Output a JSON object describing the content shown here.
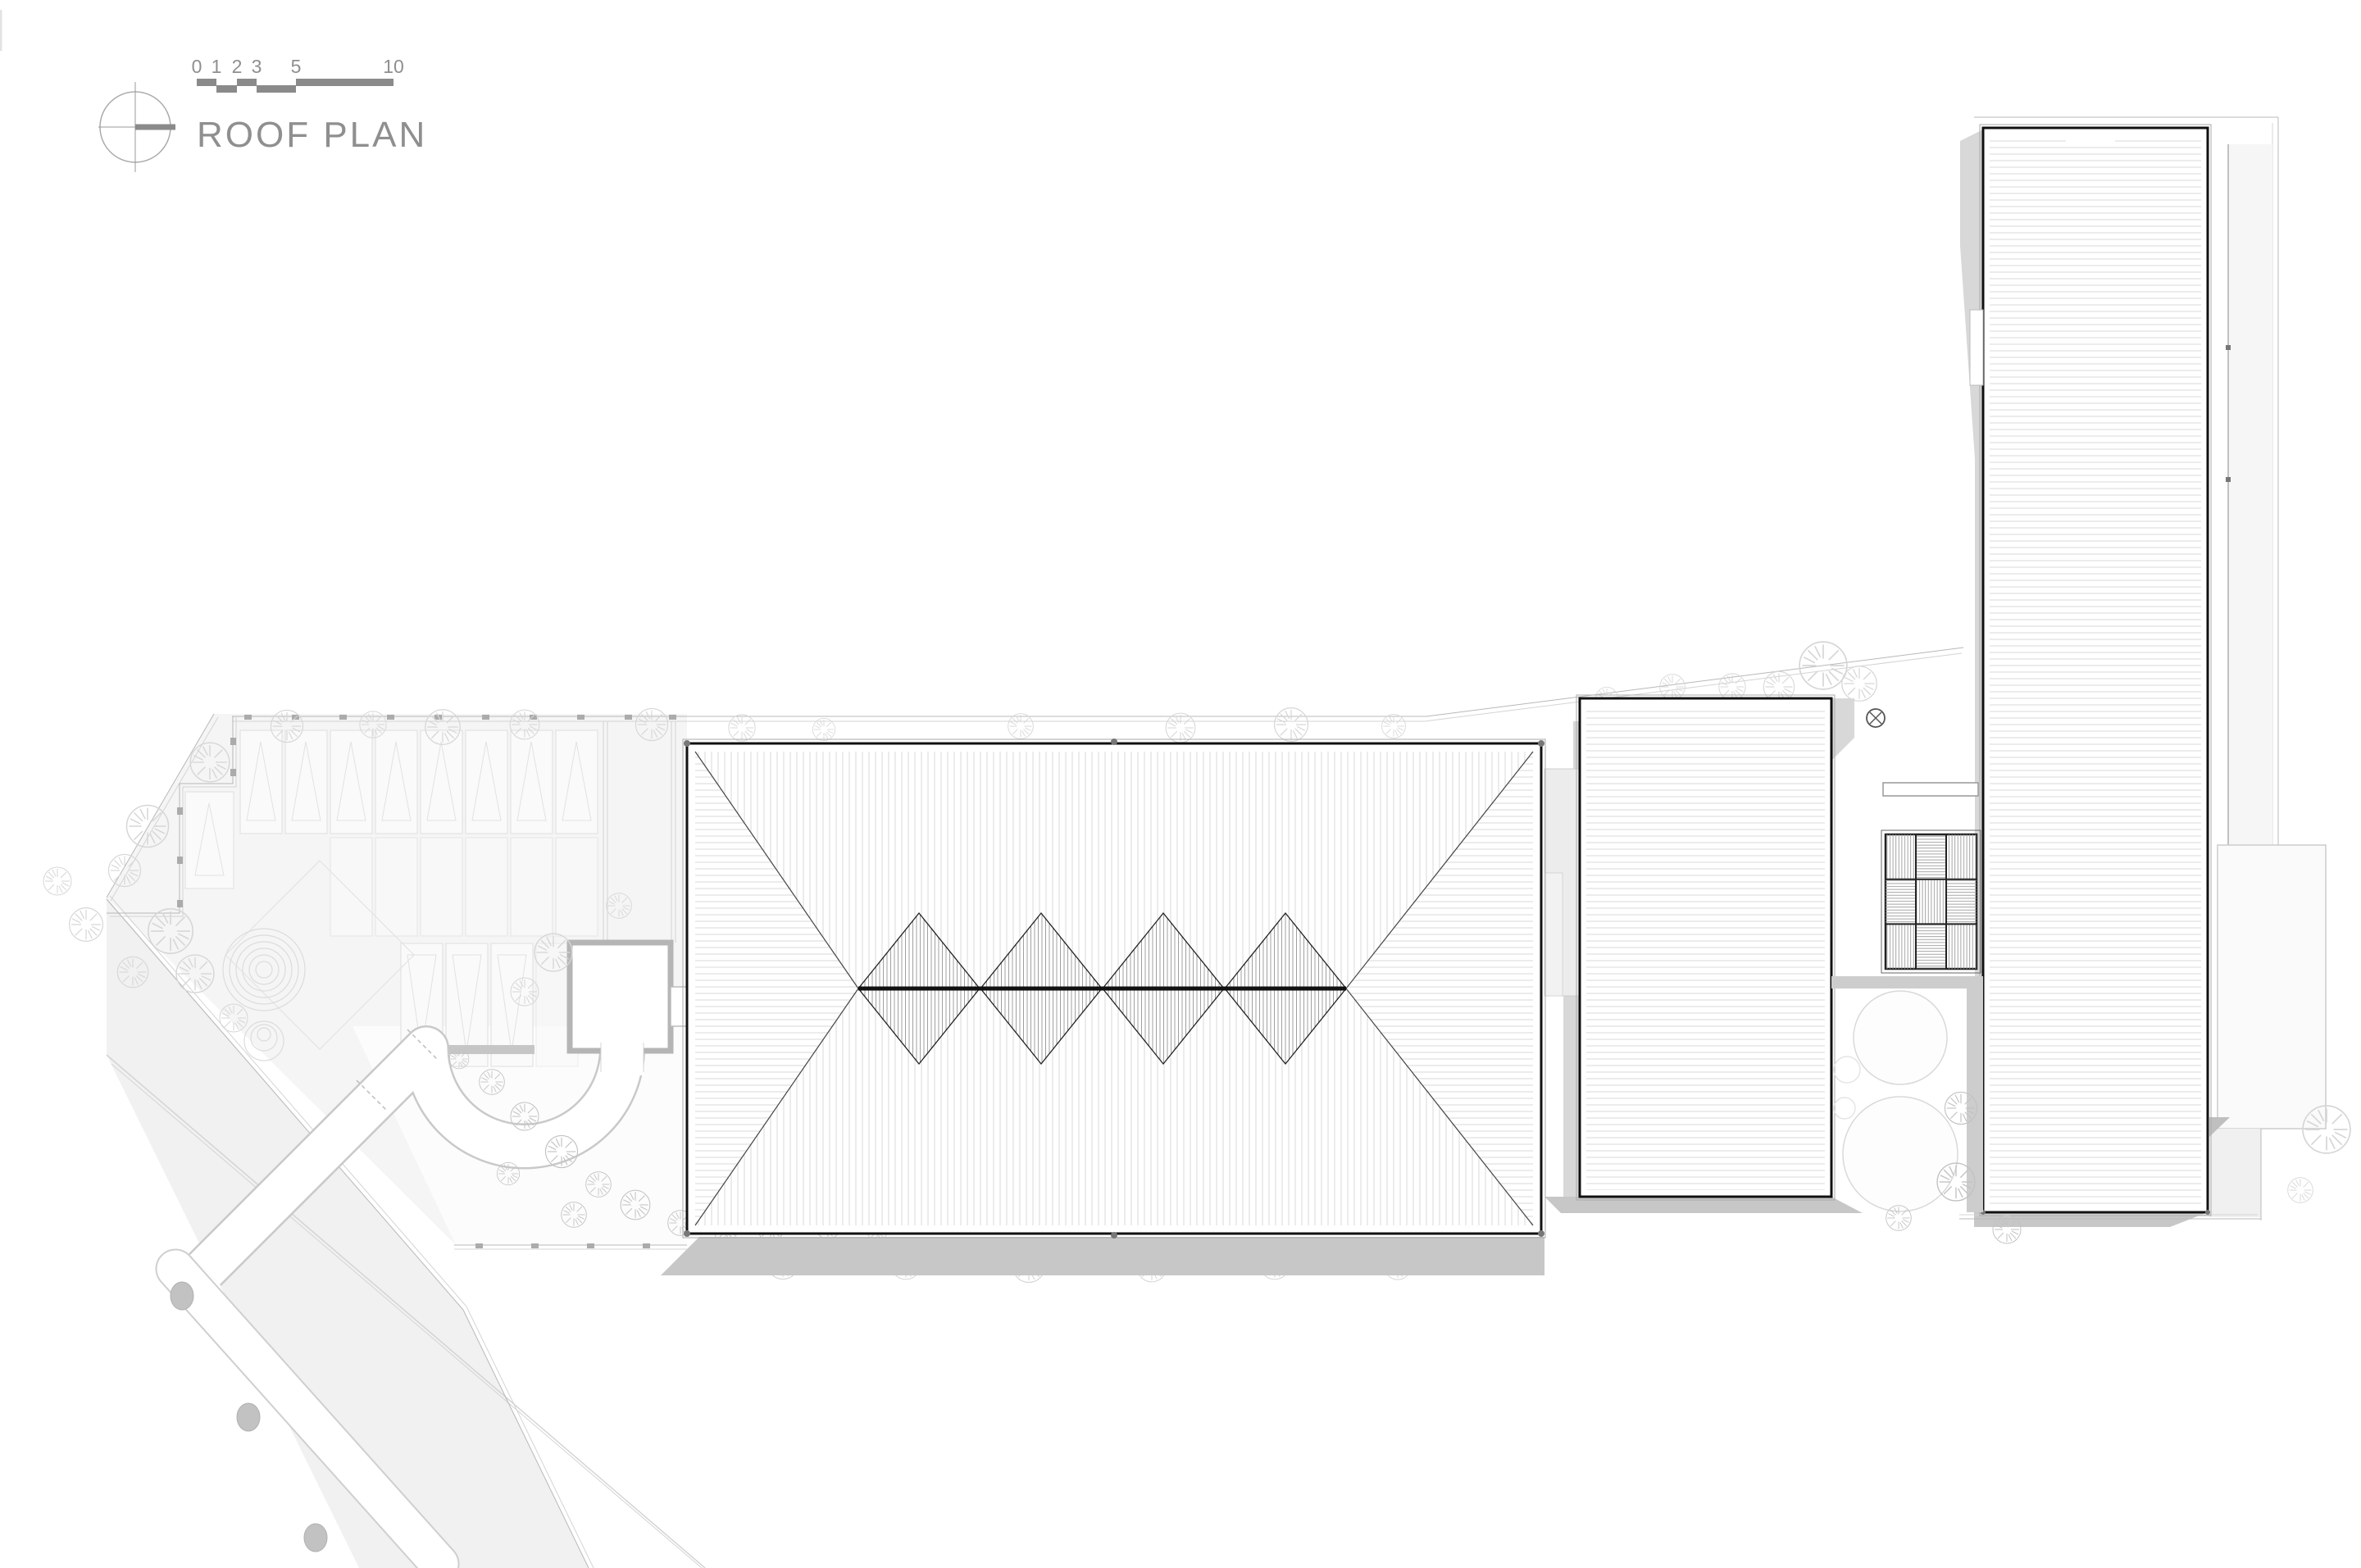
{
  "header": {
    "drawing_title": "ROOF PLAN"
  },
  "scalebar": {
    "labels": [
      "0",
      "1",
      "2",
      "3",
      "5",
      "10"
    ]
  },
  "icons": {
    "north_indicator": "compass-north-icon",
    "roof_drain": "circled-x-drain-icon"
  },
  "colors": {
    "paper": "#ffffff",
    "text": "#8f8f8f",
    "seg": "#8a8a8a",
    "line_dark": "#1a1a1a",
    "line_mid": "#8a8a8a",
    "line_light": "#b8b8b8",
    "line_faint": "#d4d4d4",
    "hatch": "#dedede",
    "hatch_dark": "#a0a0a0",
    "hatch_grid": "#9c9c9c",
    "shadow": "#c7c7c7",
    "shadow_soft": "#d8d8d8",
    "fill_garden": "#f5f5f5",
    "fill_verge": "#f1f1f1",
    "fill_pocket": "#fcfcfc",
    "fill_east": "#f6f6f6",
    "fill_bed": "#fafafa",
    "bed_line": "#e2e2e2",
    "tree": "#d6d6d6",
    "tree_dark": "#c2c2c2",
    "dot": "#777777"
  }
}
